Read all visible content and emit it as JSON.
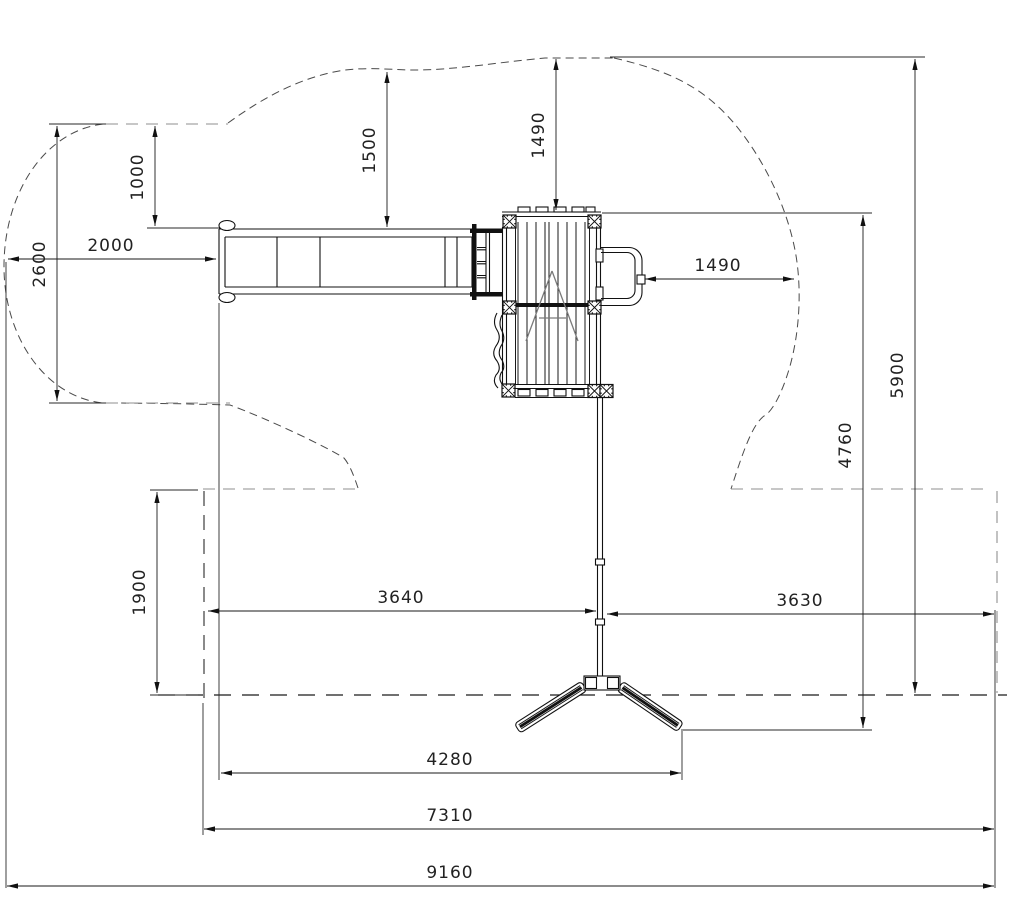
{
  "drawing": {
    "kind": "playground-equipment-plan-view",
    "units": "mm"
  },
  "colors": {
    "line": "#1a1a1a",
    "zone_dash": "#4a4a4a",
    "light_dash": "#8f8f8f",
    "background": "#ffffff"
  },
  "dims": {
    "zone_left_height": "2600",
    "zone_top_to_slide": "1000",
    "slide_top_clearance": "1500",
    "platform_top_clearance": "1490",
    "slide_zone_left": "2000",
    "platform_right_clearance": "1490",
    "zone_total_height": "5900",
    "platform_to_swing_feet": "4760",
    "zone_overlap_height": "1900",
    "beam_span_left": "3640",
    "beam_span_right": "3630",
    "slide_to_swing_feet": "4280",
    "inner_zone_width": "7310",
    "total_zone_width": "9160"
  }
}
